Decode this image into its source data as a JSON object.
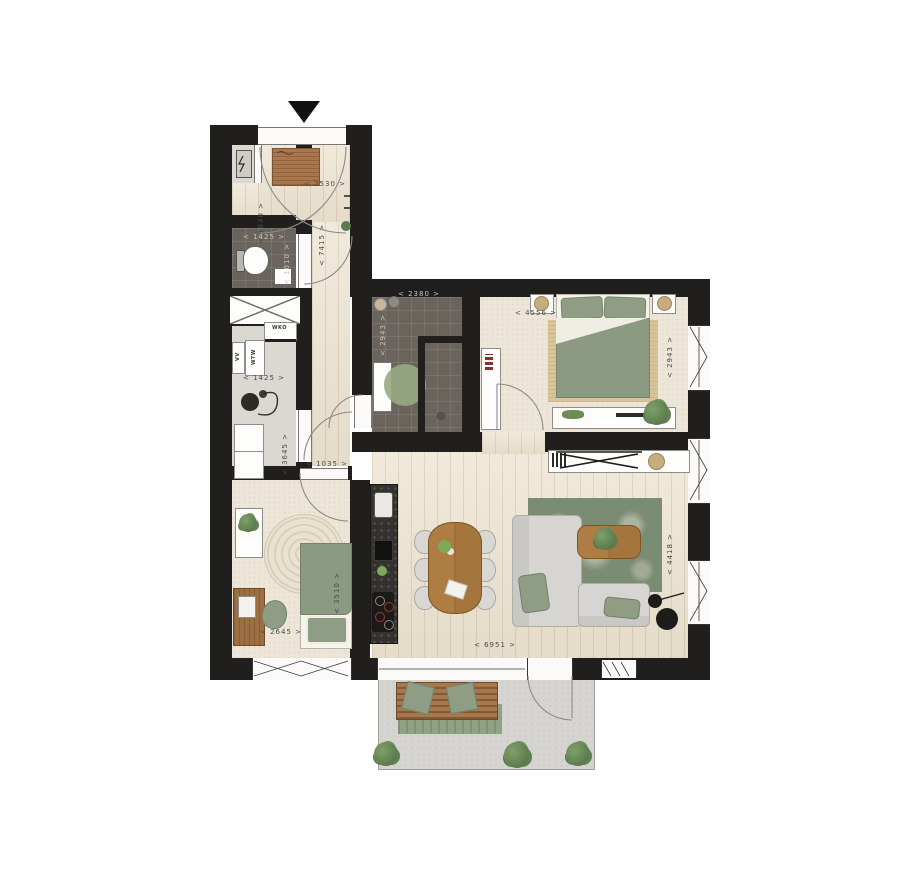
{
  "labels": {
    "entry_width": "< 2530 >",
    "entry_depth": "< 1840 >",
    "hall_length": "< 7415 >",
    "toilet_width": "< 1425 >",
    "toilet_depth": "< 1010 >",
    "storage_width": "< 1425 >",
    "storage_depth": "< 3645 >",
    "hall_width": "< 1035 >",
    "bathroom_width": "< 2380 >",
    "bathroom_depth": "< 2943 >",
    "bedroom1_width": "< 4556 >",
    "bedroom1_depth": "< 2943 >",
    "living_width": "< 6951 >",
    "living_depth": "< 4418 >",
    "bedroom2_width": "< 2645 >",
    "bedroom2_depth": "< 3510 >"
  },
  "appliances": {
    "wko": "WKO",
    "wtw": "WTW",
    "vv": "VV"
  },
  "colors": {
    "wall": "#201f1d",
    "wood_floor": "#ece2cf",
    "tile_floor": "#6a645c",
    "carpet": "#ede6d8",
    "utility_floor": "#dbd8d2",
    "terrace_concrete": "#d5d4d0",
    "sage_green": "#8e9d83",
    "rug_green": "#7b8c75",
    "furniture_wood": "#a9793f",
    "kitchen_counter": "#34322e"
  }
}
